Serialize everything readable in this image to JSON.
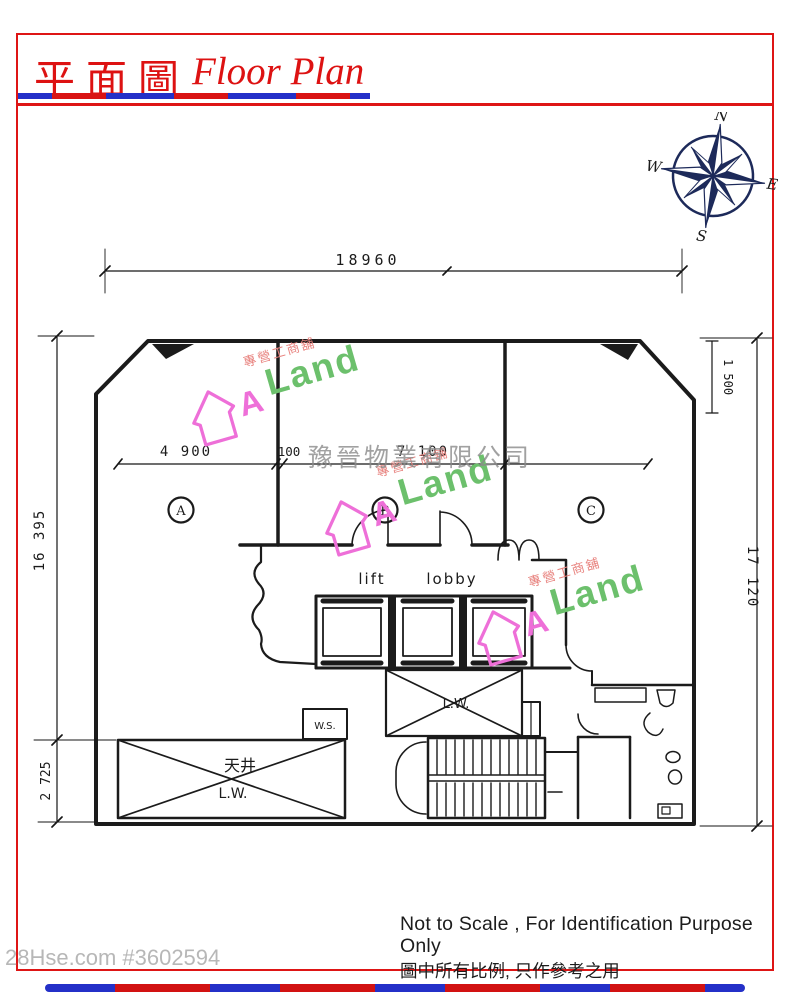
{
  "header": {
    "title_zh": "平面圖",
    "title_en": "Floor Plan"
  },
  "compass": {
    "north": "N",
    "east": "E",
    "south": "S",
    "west": "W"
  },
  "plan": {
    "unit_labels": {
      "a": "A",
      "b": "B",
      "c": "C"
    },
    "room_labels": {
      "lift": "lift",
      "lobby": "lobby",
      "light_well_center": "L.W.",
      "light_well_left": "L.W.",
      "courtyard_zh": "天井",
      "water_service": "W.S."
    },
    "dimensions": {
      "top_width": "18960",
      "left_height": "16 395",
      "left_lower": "2 725",
      "right_height": "17 120",
      "right_upper": "1 500",
      "unit_a_width": "4 900",
      "wall_thickness": "100",
      "unit_b_width": "7 100"
    }
  },
  "watermarks": {
    "agency": "豫晉物業有限公司",
    "listing": "28Hse.com #3602594",
    "brand": {
      "a": "A",
      "land": "Land",
      "tagline": "專營工商舖"
    }
  },
  "footer": {
    "line_en": "Not to Scale , For Identification Purpose Only",
    "line_zh": "圖中所有比例, 只作參考之用"
  },
  "colors": {
    "accent_red": "#de1515",
    "stripe_blue": "#2430c8",
    "compass_navy": "#1d2a5a",
    "ink": "#1b1b1b",
    "watermark_gray": "#8a8a8a",
    "brand_pink": "#ee6fd8",
    "brand_green": "#6cc06c",
    "tagline_pink": "#e8837f"
  }
}
